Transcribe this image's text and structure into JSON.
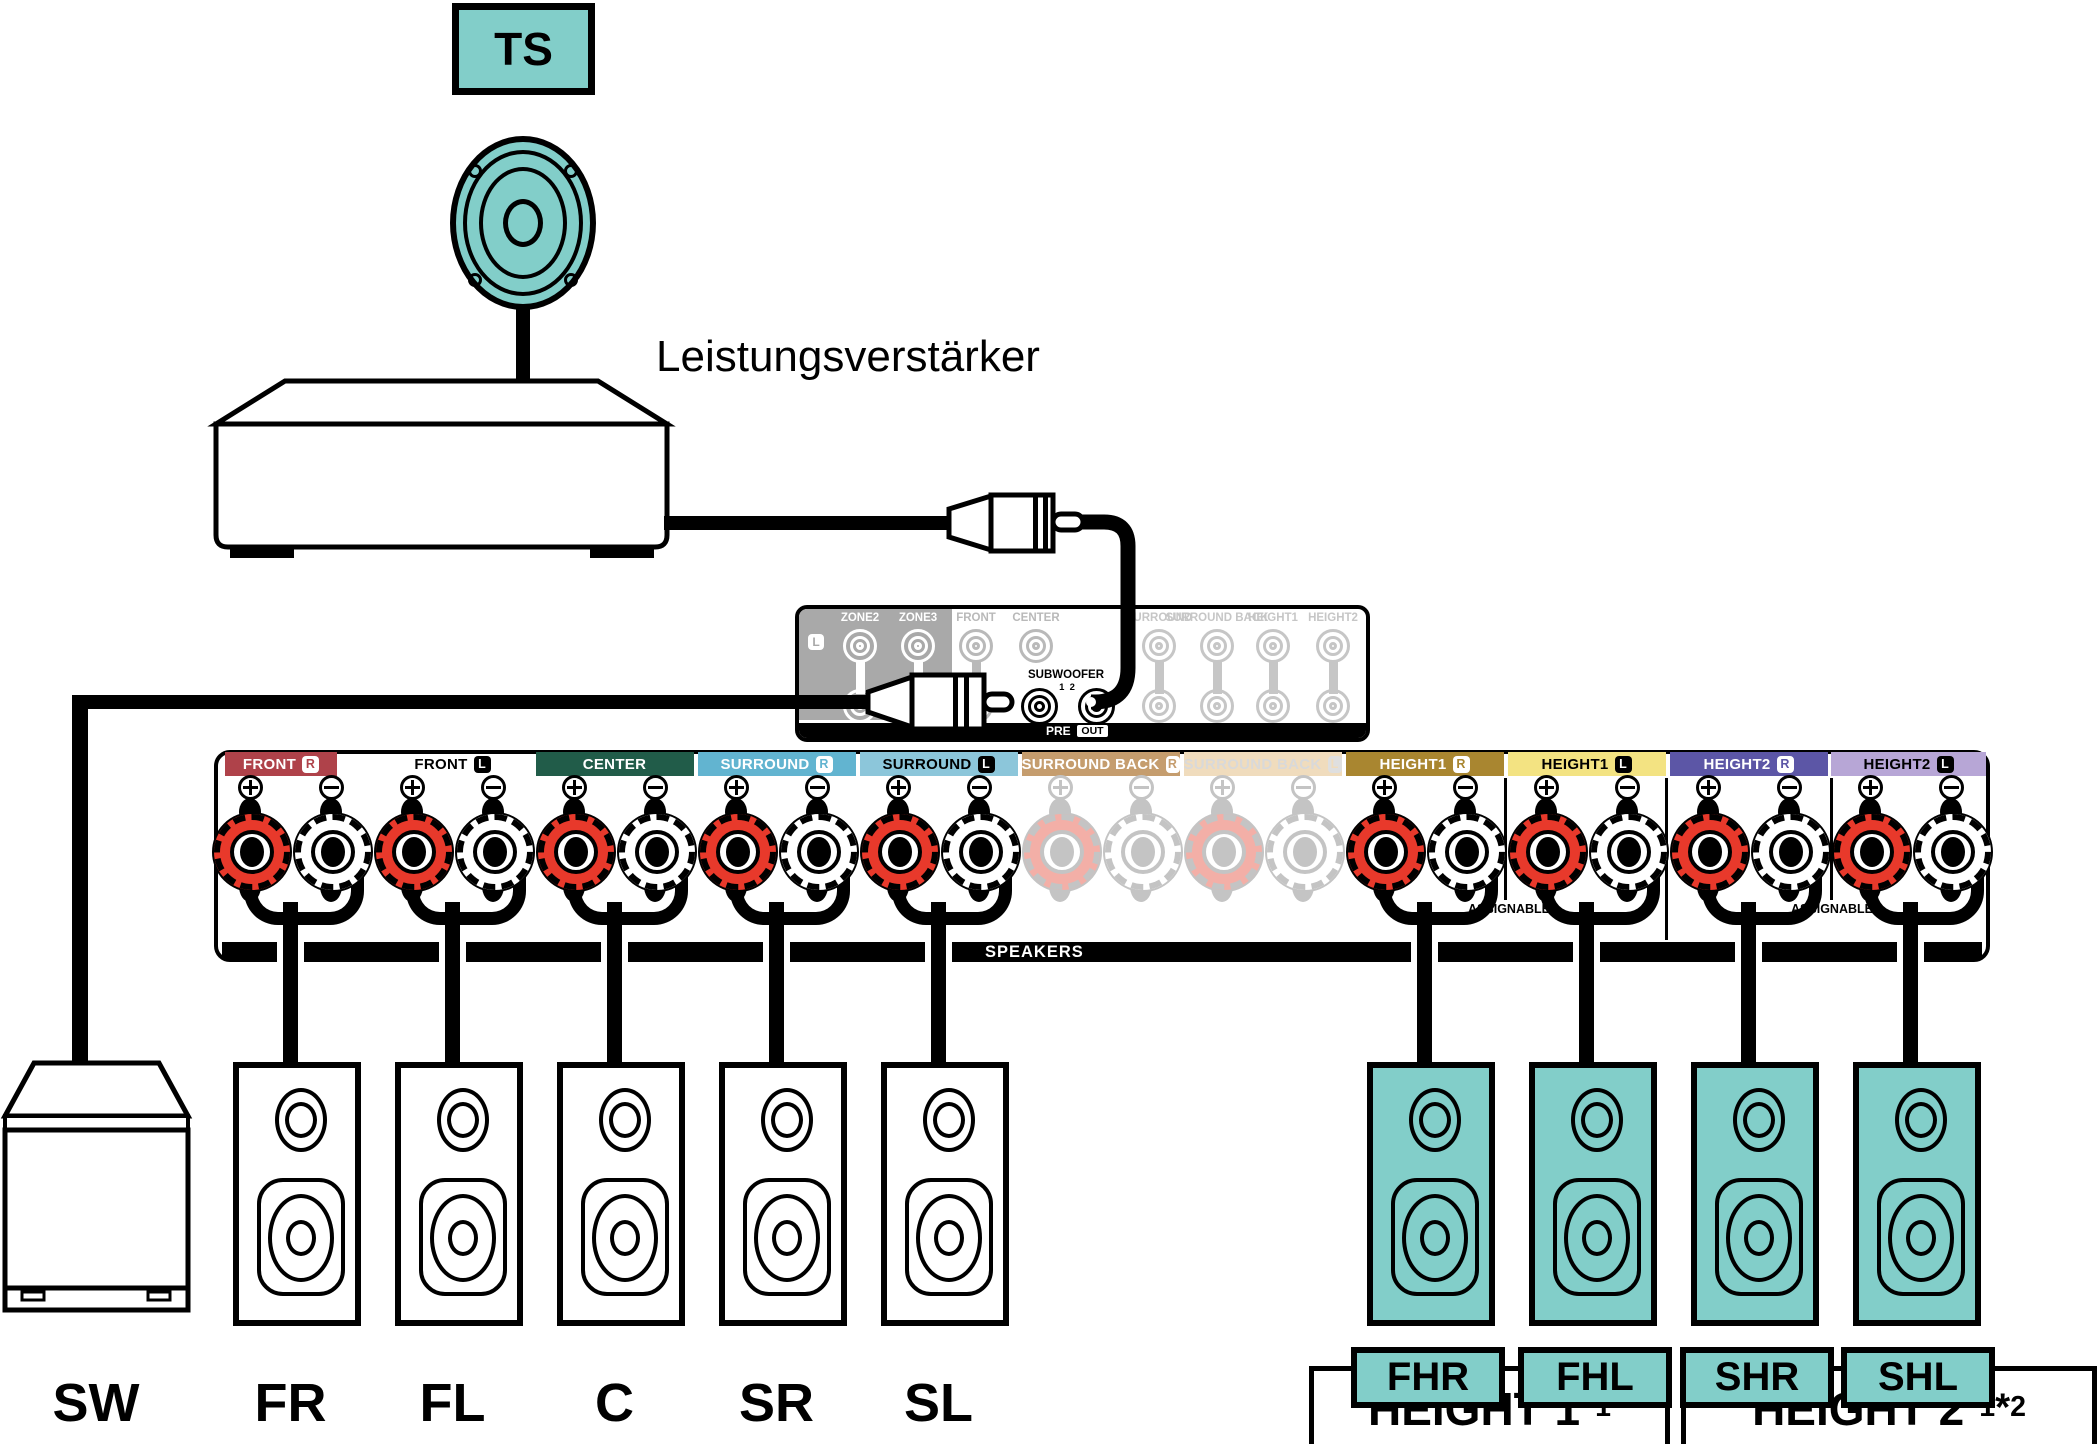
{
  "top": {
    "ts_label": "TS",
    "amp_label": "Leistungsverstärker"
  },
  "preout": {
    "l_badge": "L",
    "columns": [
      {
        "id": "zone2",
        "label": "ZONE2",
        "style": "white",
        "rows": 2
      },
      {
        "id": "zone3",
        "label": "ZONE3",
        "style": "white",
        "rows": 2
      },
      {
        "id": "front",
        "label": "FRONT",
        "style": "gray",
        "rows": 2
      },
      {
        "id": "center",
        "label": "CENTER",
        "style": "gray",
        "rows": 1
      },
      {
        "id": "surround",
        "label": "SURROUND",
        "style": "faint",
        "rows": 2
      },
      {
        "id": "surround-back",
        "label": "SURROUND BACK",
        "style": "faint",
        "rows": 2
      },
      {
        "id": "height1",
        "label": "HEIGHT1",
        "style": "faint",
        "rows": 2
      },
      {
        "id": "height2",
        "label": "HEIGHT2",
        "style": "faint",
        "rows": 2
      }
    ],
    "subwoofer_label": "SUBWOOFER",
    "subwoofer_jacks": [
      "1",
      "2"
    ],
    "pre_label": "PRE",
    "out_label": "OUT"
  },
  "terminal_strip": {
    "speakers_label": "SPEAKERS",
    "assignable_label": "ASSIGNABLE",
    "sections": [
      {
        "id": "front-r",
        "label": "FRONT",
        "channel": "R",
        "bg": "#AF424A",
        "fg": "#FFFFFF",
        "badge": "light",
        "active": true
      },
      {
        "id": "front-l",
        "label": "FRONT",
        "channel": "L",
        "bg": "none",
        "fg": "#000000",
        "badge": "dark",
        "active": true
      },
      {
        "id": "center",
        "label": "CENTER",
        "channel": "",
        "bg": "#215C49",
        "fg": "#FFFFFF",
        "badge": "none",
        "active": true
      },
      {
        "id": "surround-r",
        "label": "SURROUND",
        "channel": "R",
        "bg": "#62B4D0",
        "fg": "#FFFFFF",
        "badge": "light",
        "active": true
      },
      {
        "id": "surround-l",
        "label": "SURROUND",
        "channel": "L",
        "bg": "#8CC6DA",
        "fg": "#000000",
        "badge": "dark",
        "active": true
      },
      {
        "id": "surround-back-r",
        "label": "SURROUND BACK",
        "channel": "R",
        "bg": "#C59D6E",
        "fg": "#FFFFFF",
        "badge": "light",
        "active": false
      },
      {
        "id": "surround-back-l",
        "label": "SURROUND BACK",
        "channel": "L",
        "bg": "#F0DCBD",
        "fg": "#D9D9D9",
        "badge": "faded",
        "active": false
      },
      {
        "id": "height1-r",
        "label": "HEIGHT1",
        "channel": "R",
        "bg": "#A98630",
        "fg": "#FFFFFF",
        "badge": "light",
        "active": true
      },
      {
        "id": "height1-l",
        "label": "HEIGHT1",
        "channel": "L",
        "bg": "#F3E382",
        "fg": "#000000",
        "badge": "dark",
        "active": true
      },
      {
        "id": "height2-r",
        "label": "HEIGHT2",
        "channel": "R",
        "bg": "#5C56A6",
        "fg": "#FFFFFF",
        "badge": "light",
        "active": true
      },
      {
        "id": "height2-l",
        "label": "HEIGHT2",
        "channel": "L",
        "bg": "#B7A6D6",
        "fg": "#000000",
        "badge": "dark",
        "active": true
      }
    ]
  },
  "speakers": {
    "subwoofer": {
      "label": "SW"
    },
    "main": [
      {
        "id": "fr",
        "label": "FR"
      },
      {
        "id": "fl",
        "label": "FL"
      },
      {
        "id": "c",
        "label": "C"
      },
      {
        "id": "sr",
        "label": "SR"
      },
      {
        "id": "sl",
        "label": "SL"
      }
    ],
    "height": [
      {
        "id": "fhr",
        "label": "FHR"
      },
      {
        "id": "fhl",
        "label": "FHL"
      },
      {
        "id": "shr",
        "label": "SHR"
      },
      {
        "id": "shl",
        "label": "SHL"
      }
    ],
    "group_boxes": [
      {
        "name": "HEIGHT 1",
        "marks": [
          "*1"
        ]
      },
      {
        "name": "HEIGHT 2",
        "marks": [
          "*1",
          "*2"
        ]
      }
    ]
  },
  "colors": {
    "speaker_teal": "#82CEC9",
    "post_red": "#E8392B",
    "faded_red": "#F3AFA7",
    "faded_line": "#C4C4C4",
    "panel_gray": "#A9A9A9",
    "gray_label": "#B9B9B9",
    "faint_label": "#C6C6C6",
    "line_black": "#000000"
  }
}
